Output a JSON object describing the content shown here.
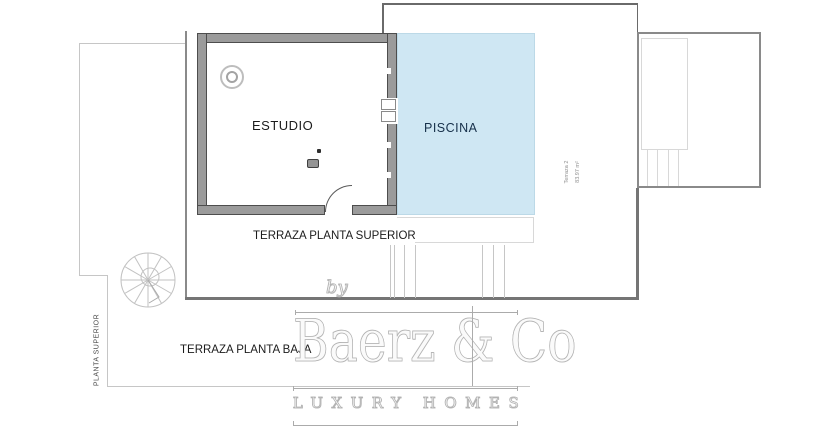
{
  "labels": {
    "estudio": "ESTUDIO",
    "piscina": "PISCINA",
    "terraza_planta_superior": "TERRAZA PLANTA SUPERIOR",
    "terraza_planta_baja": "TERRAZA PLANTA BAJA",
    "planta_superior": "PLANTA SUPERIOR",
    "area_note_line1": "Terraza 2",
    "area_note_line2": "83.97 m²"
  },
  "watermark": {
    "by": "by",
    "brand": "Baerz & Co",
    "tagline": "LUXURY HOMES"
  },
  "colors": {
    "pool_fill": "#cfe7f3",
    "pool_edge": "#bcd9e7",
    "wall_fill": "#9b9b9b",
    "wall_edge": "#4d4d4d",
    "boundary_dark": "#757575",
    "line_light": "#c6c6c6",
    "label_text": "#1c1c1c",
    "piscina_text": "#17304a",
    "watermark_gray": "#b2b2b2"
  }
}
